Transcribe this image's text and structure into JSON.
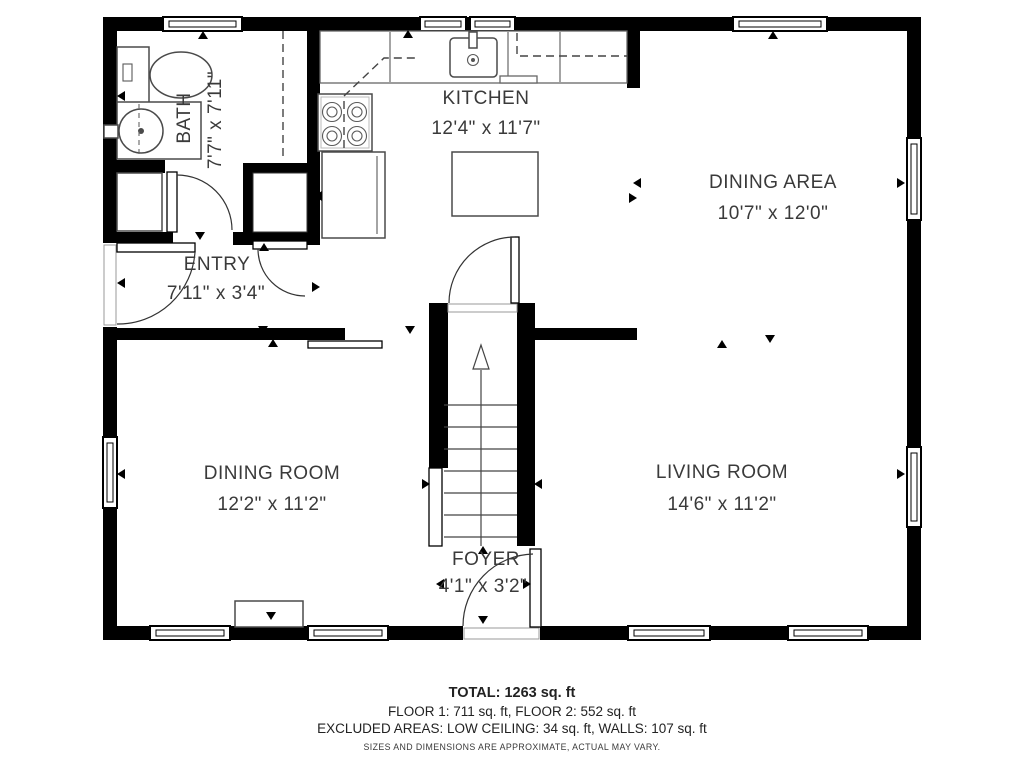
{
  "floorplan": {
    "rooms": [
      {
        "name": "BATH",
        "dims": "7'7\" x 7'11\""
      },
      {
        "name": "KITCHEN",
        "dims": "12'4\" x 11'7\""
      },
      {
        "name": "DINING AREA",
        "dims": "10'7\" x 12'0\""
      },
      {
        "name": "ENTRY",
        "dims": "7'11\" x 3'4\""
      },
      {
        "name": "DINING ROOM",
        "dims": "12'2\" x 11'2\""
      },
      {
        "name": "LIVING ROOM",
        "dims": "14'6\" x 11'2\""
      },
      {
        "name": "FOYER",
        "dims": "4'1\" x 3'2\""
      }
    ],
    "summary": {
      "total": "TOTAL: 1263 sq. ft",
      "floors": "FLOOR 1: 711 sq. ft, FLOOR 2: 552 sq. ft",
      "excluded": "EXCLUDED AREAS: LOW CEILING: 34 sq. ft, WALLS: 107 sq. ft",
      "disclaimer": "SIZES AND DIMENSIONS ARE APPROXIMATE, ACTUAL MAY VARY."
    },
    "colors": {
      "wall": "#000000",
      "label_text": "#3a3a3a",
      "background": "#ffffff"
    }
  }
}
